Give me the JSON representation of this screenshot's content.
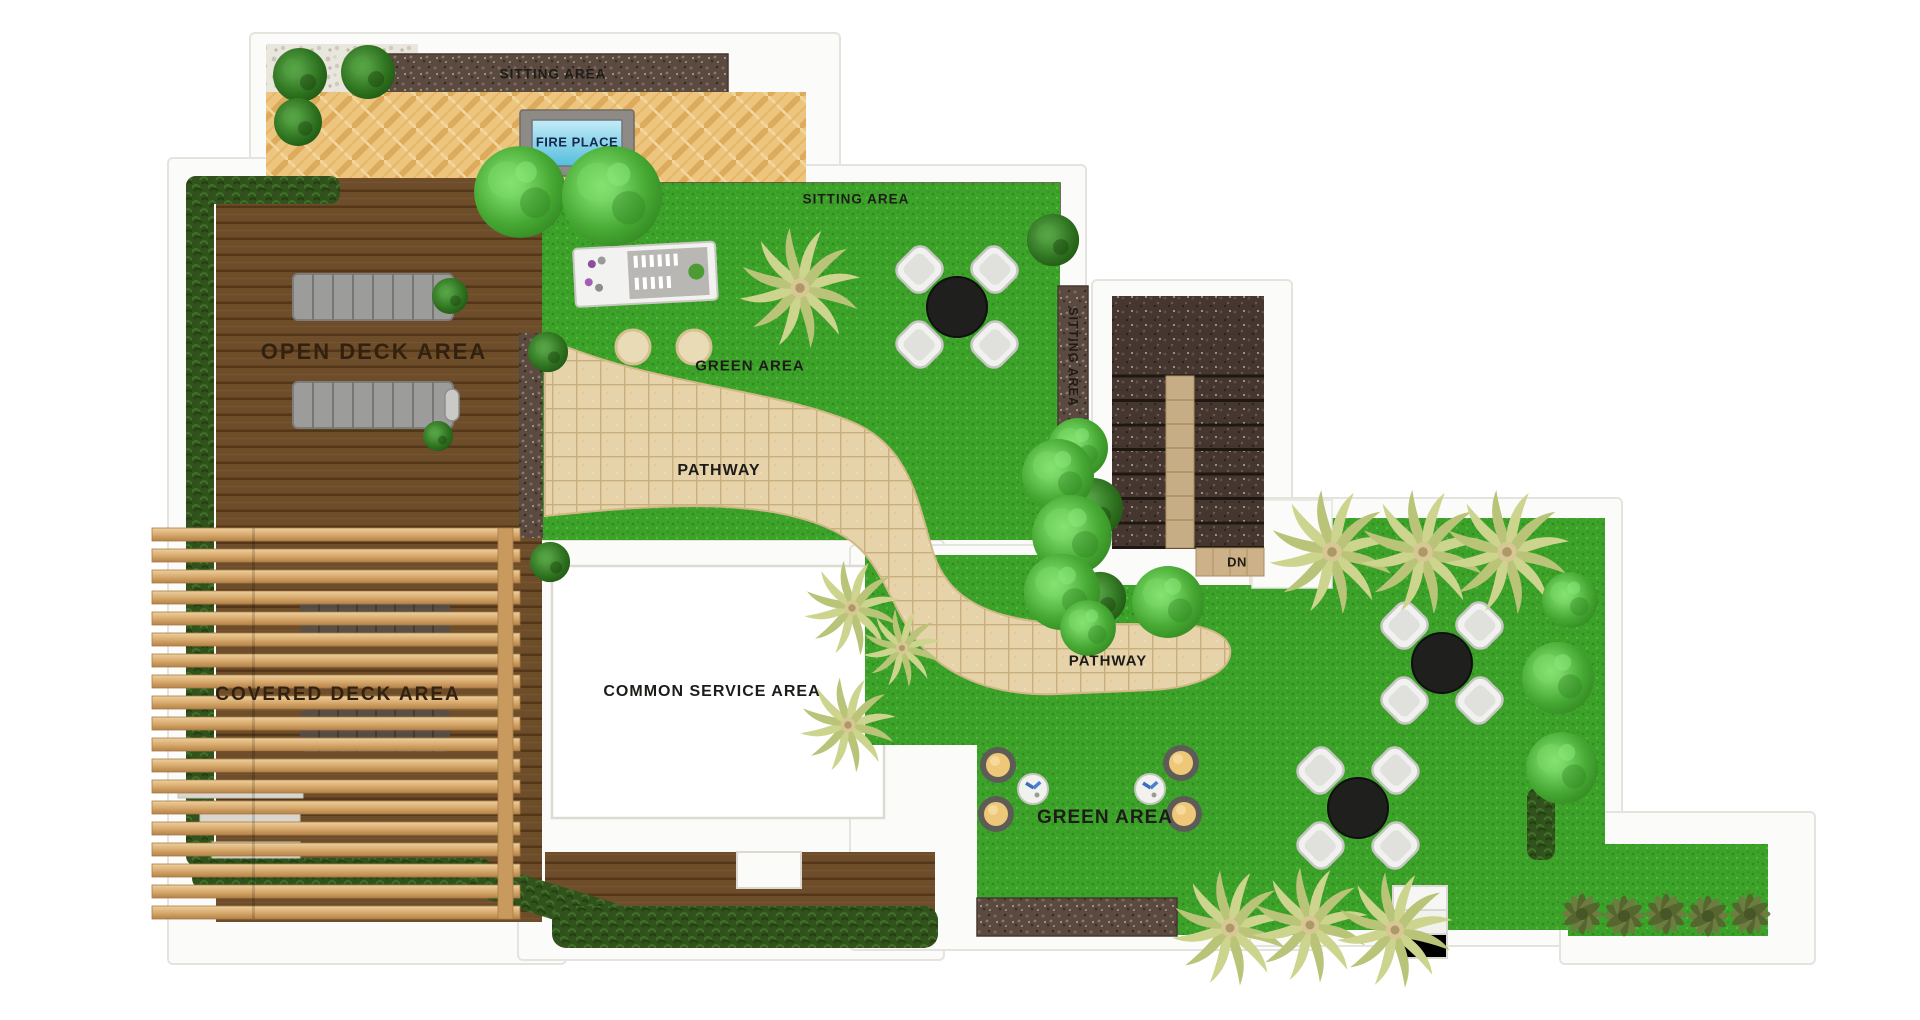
{
  "plan": {
    "labels": {
      "sitting_area_top": "SITTING AREA",
      "fire_place": "FIRE PLACE",
      "sitting_area_mid": "SITTING AREA",
      "sitting_area_side": "SITTING AREA",
      "open_deck_area": "OPEN DECK AREA",
      "green_area_top": "GREEN AREA",
      "pathway_upper": "PATHWAY",
      "pathway_lower": "PATHWAY",
      "covered_deck_area": "COVERED DECK AREA",
      "common_service_area": "COMMON SERVICE AREA",
      "green_area_bottom": "GREEN AREA",
      "stairs_direction": "DN"
    },
    "colors": {
      "grass": "#3da22a",
      "grass_dark": "#2f8c1c",
      "deck_wood": "#6e4d2a",
      "deck_line": "#543619",
      "pergola_wood": "#d9ab6d",
      "parquet": "#edc57f",
      "paved_stone": "#5b4a3f",
      "pathway_tile": "#e7d3a9",
      "hedge": "#31521c",
      "wall": "#fbfbf9",
      "wall_edge": "#e5e3dd",
      "water_blue": "#54bede",
      "fireplace_frame": "#8e8a86",
      "palm_leaf": "#ccd48d",
      "tree_green": "#46a933",
      "table_black": "#1f1f1e",
      "chair_white": "#f1f1ef",
      "cushion_yellow": "#eec878",
      "stool_cream": "#eadbb7",
      "pebble": "#e9e6de",
      "stair_tile": "#c7ad85"
    }
  }
}
